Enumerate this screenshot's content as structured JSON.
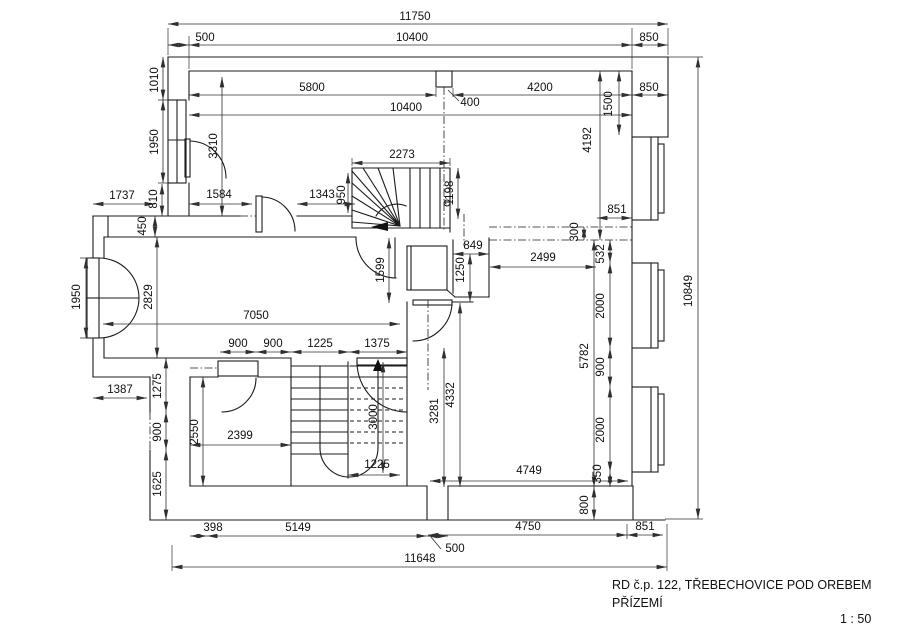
{
  "title_block": {
    "line1": "RD č.p. 122, TŘEBECHOVICE POD OREBEM",
    "line2": "PŘÍZEMÍ",
    "scale": "1 : 50"
  },
  "dims": {
    "overall_width": "11750",
    "wall_left": "500",
    "inner_width_top": "10400",
    "bay_depth_a": "850",
    "seg_5800": "5800",
    "seg_4200": "4200",
    "bay_depth_b": "850",
    "inner_width2": "10400",
    "chimney": "400",
    "v1010": "1010",
    "v1950_window": "1950",
    "v3310": "3310",
    "h1737": "1737",
    "v810": "810",
    "h1584": "1584",
    "h1343": "1343",
    "v950": "950",
    "h2273": "2273",
    "v1198": "1198",
    "v450": "450",
    "v2829": "2829",
    "v1950_door": "1950",
    "h851_step": "851",
    "v300": "300",
    "h849": "849",
    "h2499": "2499",
    "v1599": "1599",
    "v1250": "1250",
    "v532": "532",
    "v2000_a": "2000",
    "v4192": "4192",
    "v1500": "1500",
    "v10849": "10849",
    "h7050": "7050",
    "v5782": "5782",
    "v900_r": "900",
    "v2000_b": "2000",
    "v350": "350",
    "v800": "800",
    "h4749": "4749",
    "h4750": "4750",
    "h851_b": "851",
    "h500_b": "500",
    "h11648": "11648",
    "h398": "398",
    "h5149": "5149",
    "h900_a": "900",
    "h900_b": "900",
    "h1225_a": "1225",
    "h1375": "1375",
    "v1275": "1275",
    "v900_c": "900",
    "v1625": "1625",
    "h1387": "1387",
    "v2550": "2550",
    "h2399": "2399",
    "v3000": "3000",
    "h1225_b": "1225",
    "v3281": "3281",
    "v4332": "4332"
  }
}
